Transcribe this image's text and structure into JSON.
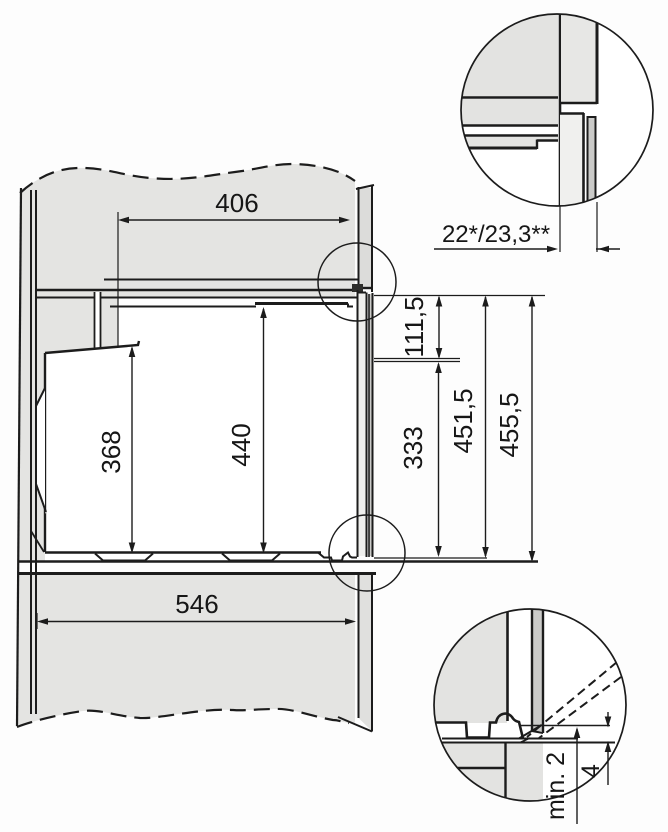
{
  "drawing": {
    "dimensions": {
      "top_depth": "406",
      "bottom_depth": "546",
      "rear_height": "368",
      "front_height": "440",
      "upper_front_offset": "111,5",
      "lower_front_offset": "333",
      "front_height_inner": "451,5",
      "front_height_outer": "455,5",
      "front_frame_gap": "22*/23,3**",
      "bottom_clearance": "min. 2",
      "bottom_gap": "4"
    }
  }
}
